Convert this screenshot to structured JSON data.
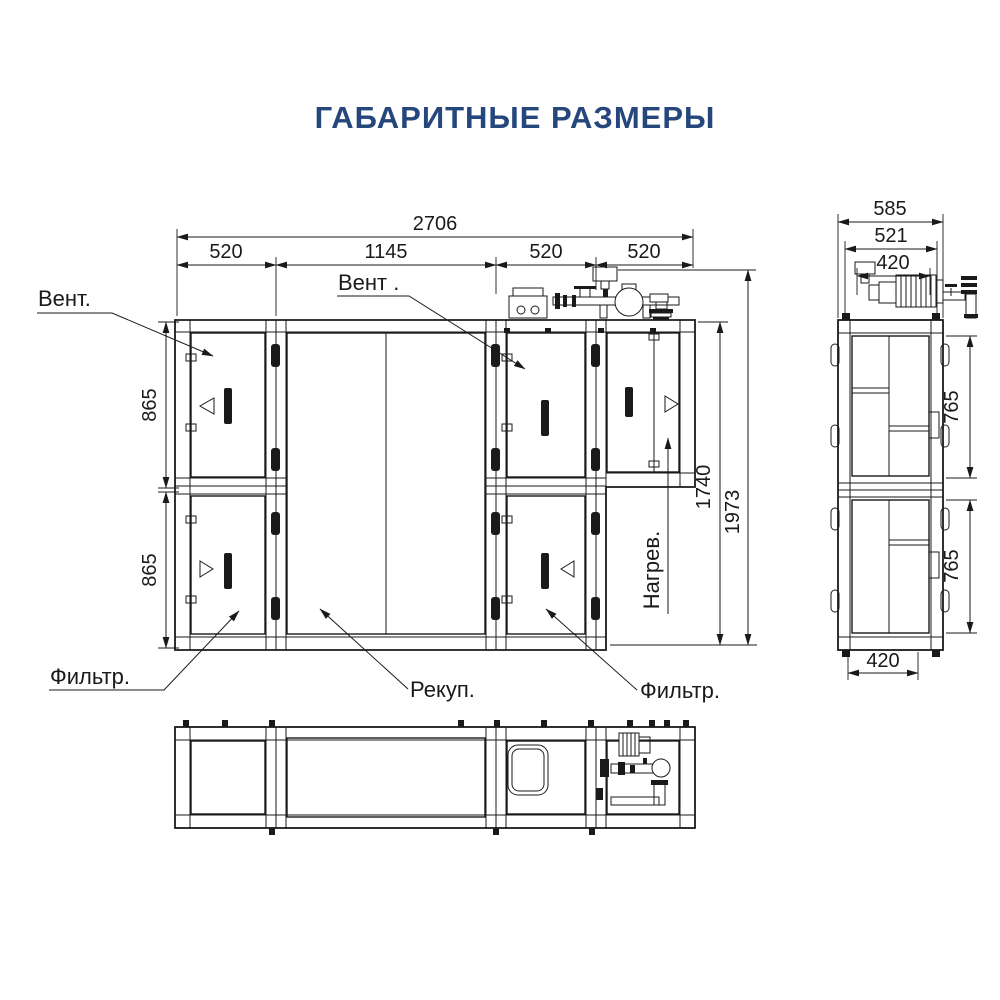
{
  "title": "ГАБАРИТНЫЕ РАЗМЕРЫ",
  "colors": {
    "accent": "#26477b",
    "line": "#1a1a1a"
  },
  "front_view": {
    "dim_total_width": "2706",
    "dim_sections": [
      "520",
      "1145",
      "520",
      "520"
    ],
    "dim_upper_height": "865",
    "dim_lower_height": "865",
    "dim_body_height": "1740",
    "dim_overall_height": "1973",
    "labels": {
      "fan_left": "Вент.",
      "fan_center": "Вент .",
      "filter_left": "Фильтр.",
      "filter_right": "Фильтр.",
      "recuperator": "Рекуп.",
      "heater": "Нагрев."
    }
  },
  "side_view": {
    "dim_overall_width": "585",
    "dim_mid_width": "521",
    "dim_pump_width": "420",
    "dim_upper_height": "765",
    "dim_lower_height": "765",
    "dim_bottom_width": "420"
  }
}
